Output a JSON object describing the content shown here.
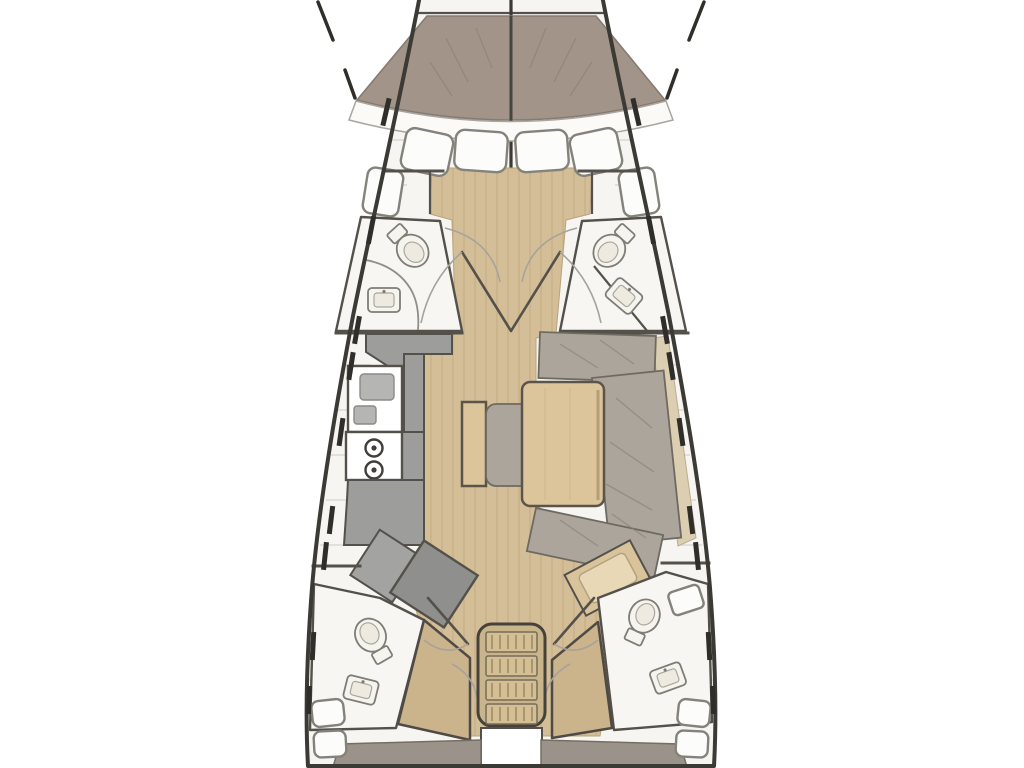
{
  "figure": {
    "type": "floorplan",
    "subject": "sailboat-interior-top-view",
    "orientation": "bow-up"
  },
  "colors": {
    "outline": "#3b3a35",
    "wall": "#53514a",
    "deck": "#f6f5f1",
    "seam": "#dbdad3",
    "wood": "#d4be97",
    "plank": "#c0a97f",
    "mattress": "#a29488",
    "settee": "#aba59b",
    "shelf": "#dcceb0",
    "counter": "#9d9d9b",
    "counter_dark": "#b5b5b3",
    "table": "#dcc59b",
    "stairs": "#c9b58c",
    "berth": "#cbb38c",
    "seat_tan": "#d9c39a",
    "floor_gray": "#9b9289",
    "porcelain": "#f6f4ee",
    "fixture_line": "#7e7d76",
    "white": "#ffffff",
    "dash": "#2f2e2a"
  },
  "areas": [
    "anchor-locker",
    "v-berth",
    "forward-port-head",
    "forward-starboard-head",
    "galley",
    "salon-settee",
    "salon-table",
    "nav-station",
    "aft-port-head",
    "aft-starboard-head",
    "port-aft-berth",
    "starboard-aft-berth",
    "companionway-stairs",
    "cockpit-sole"
  ],
  "fixtures": {
    "toilets": 4,
    "bathroom_sinks": 4,
    "galley_burners": 2,
    "companionway_treads": 4,
    "bow_locker_cushions": 4,
    "foredeck_side_lockers": 2,
    "aft_corner_lockers": 4
  }
}
